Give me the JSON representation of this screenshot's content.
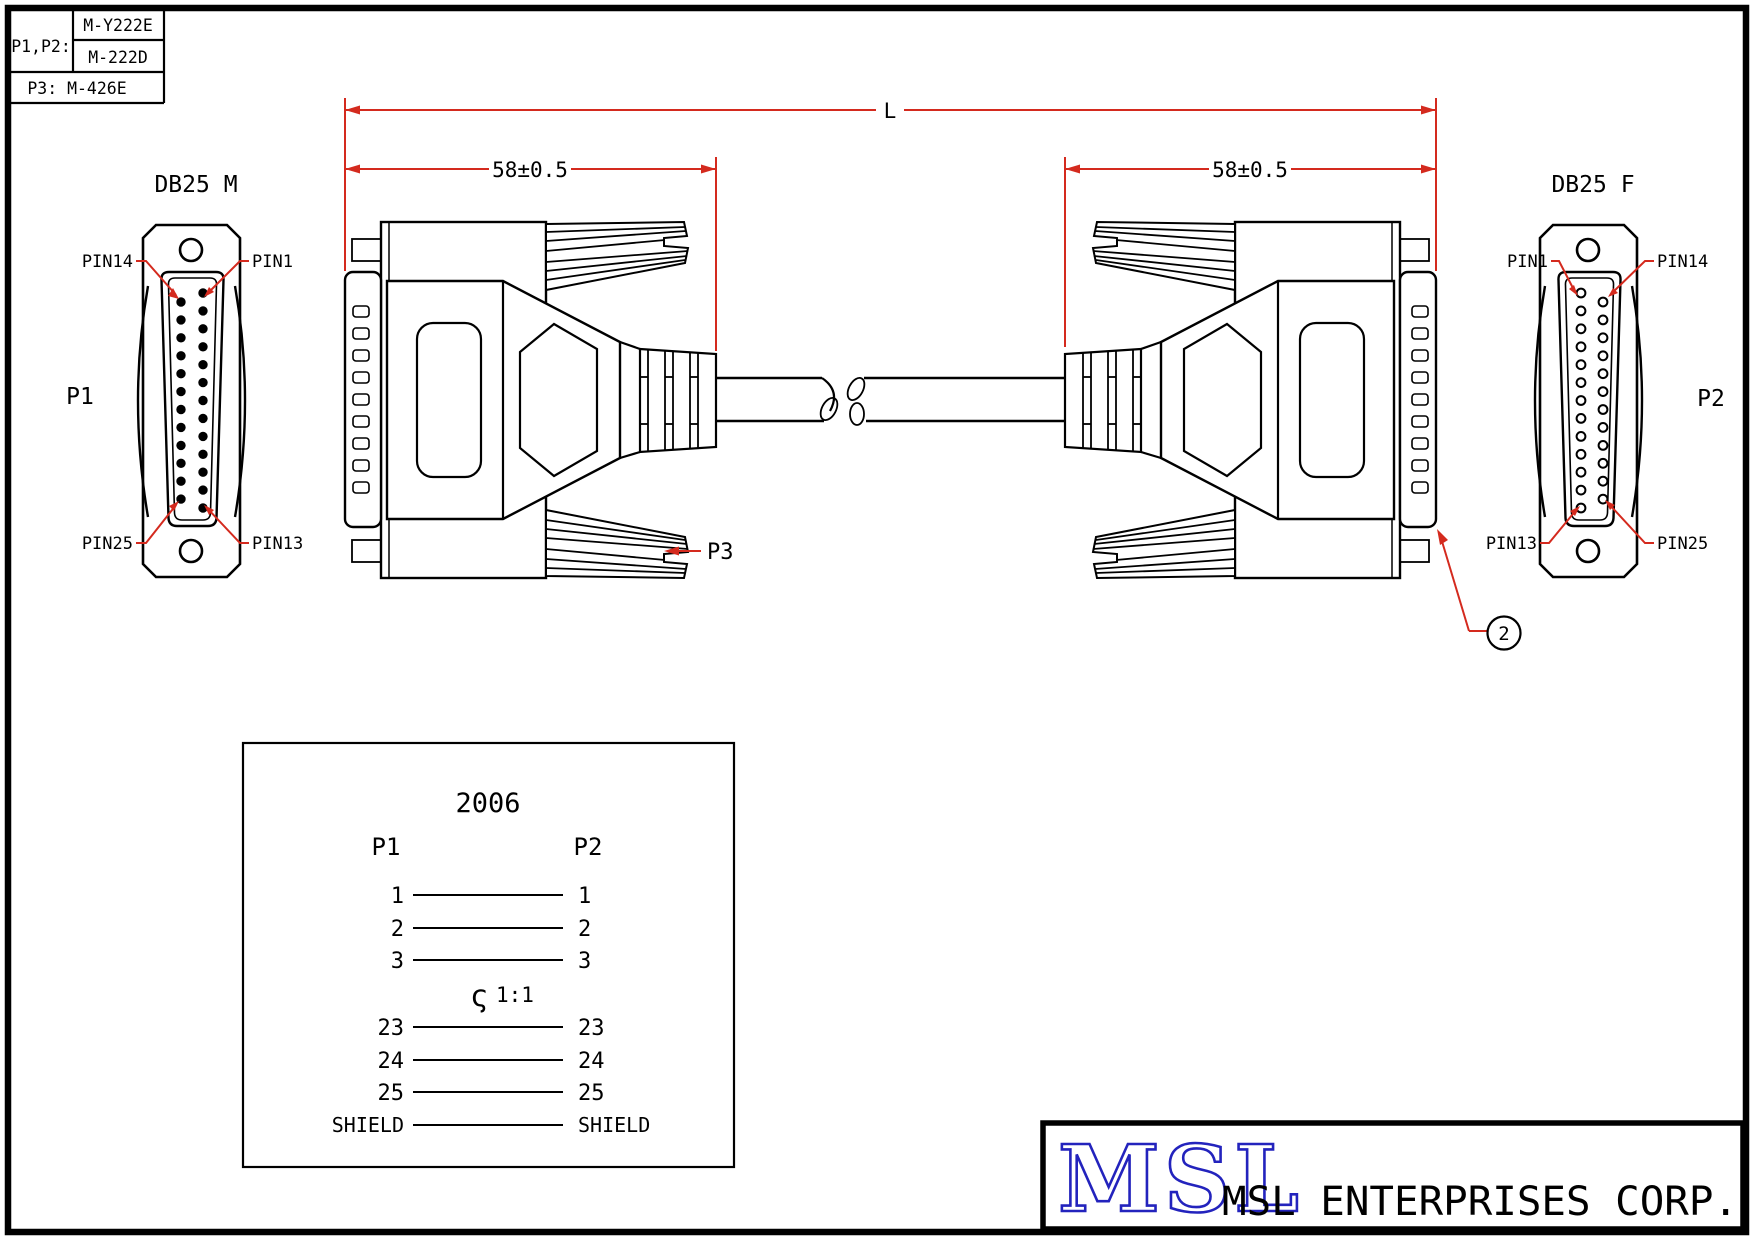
{
  "colors": {
    "background": "#ffffff",
    "line": "#000000",
    "dimension_red": "#d42a1e",
    "logo_blue": "#2323bd"
  },
  "part_table": {
    "connectors_label": "P1,P2:",
    "part_number_top": "M-Y222E",
    "part_number_bottom": "M-222D",
    "p3_part": "P3: M-426E"
  },
  "left_face": {
    "title": "DB25 M",
    "ref": "P1",
    "pin_top_left": "PIN14",
    "pin_top_right": "PIN1",
    "pin_bottom_left": "PIN25",
    "pin_bottom_right": "PIN13",
    "pin_count_col_a": 13,
    "pin_count_col_b": 12
  },
  "right_face": {
    "title": "DB25 F",
    "ref": "P2",
    "pin_top_left": "PIN1",
    "pin_top_right": "PIN14",
    "pin_bottom_left": "PIN13",
    "pin_bottom_right": "PIN25",
    "pin_count_col_a": 13,
    "pin_count_col_b": 12
  },
  "dimensions": {
    "overall_length": "L",
    "left_molded": "58±0.5",
    "right_molded": "58±0.5"
  },
  "callouts": {
    "strain_relief": "P3",
    "balloon_number": "2"
  },
  "wiring_diagram": {
    "title": "2006",
    "left_header": "P1",
    "right_header": "P2",
    "rows": [
      {
        "left": "1",
        "right": "1"
      },
      {
        "left": "2",
        "right": "2"
      },
      {
        "left": "3",
        "right": "3"
      },
      {
        "left": "23",
        "right": "23"
      },
      {
        "left": "24",
        "right": "24"
      },
      {
        "left": "25",
        "right": "25"
      },
      {
        "left": "SHIELD",
        "right": "SHIELD"
      }
    ],
    "continuation_symbol": "ς",
    "continuation_note": "1:1"
  },
  "title_block": {
    "logo_text": "MSL",
    "company_name": "MSL ENTERPRISES CORP."
  }
}
